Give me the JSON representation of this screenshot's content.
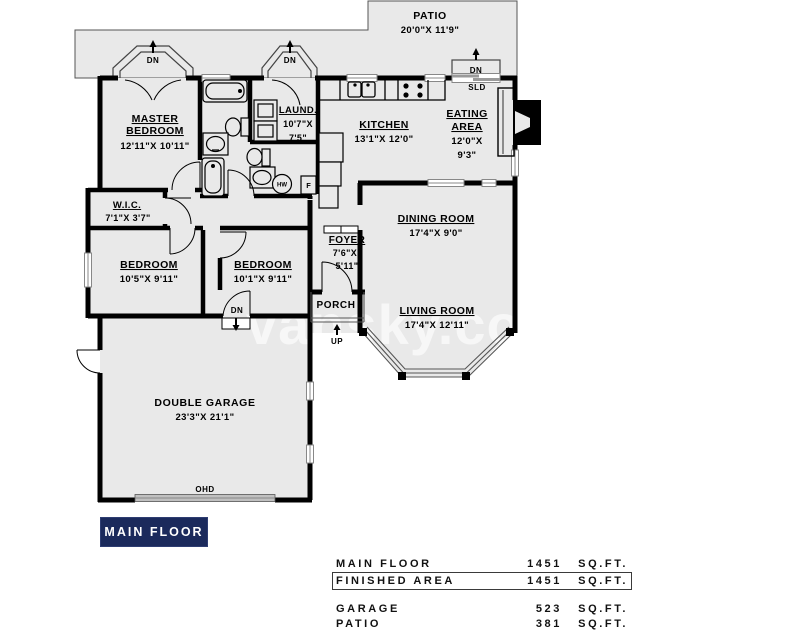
{
  "watermark": "vansky.com",
  "badge": {
    "label": "MAIN FLOOR"
  },
  "rooms": {
    "patio": {
      "name": "PATIO",
      "dims": "20'0\"X  11'9\""
    },
    "master": {
      "line1": "MASTER",
      "line2": "BEDROOM",
      "dims": "12'11\"X  10'11\""
    },
    "laundry": {
      "name": "LAUND.",
      "dims1": "10'7\"X",
      "dims2": "7'5\""
    },
    "kitchen": {
      "name": "KITCHEN",
      "dims": "13'1\"X  12'0\""
    },
    "eating": {
      "line1": "EATING",
      "line2": "AREA",
      "dims1": "12'0\"X",
      "dims2": "9'3\""
    },
    "dining": {
      "name": "DINING  ROOM",
      "dims": "17'4\"X  9'0\""
    },
    "wic": {
      "name": "W.I.C.",
      "dims": "7'1\"X  3'7\""
    },
    "bedroom_left": {
      "name": "BEDROOM",
      "dims": "10'5\"X  9'11\""
    },
    "bedroom_mid": {
      "name": "BEDROOM",
      "dims": "10'1\"X  9'11\""
    },
    "foyer": {
      "name": "FOYER",
      "dims1": "7'6\"X",
      "dims2": "5'11\""
    },
    "porch": {
      "name": "PORCH"
    },
    "living": {
      "name": "LIVING  ROOM",
      "dims": "17'4\"X  12'11\""
    },
    "garage": {
      "name": "DOUBLE  GARAGE",
      "dims": "23'3\"X  21'1\""
    }
  },
  "annotations": {
    "dn": "DN",
    "up": "UP",
    "sld": "SLD",
    "ohd": "OHD",
    "hw": "HW",
    "f": "F"
  },
  "area_table": {
    "rows": [
      {
        "label": "MAIN FLOOR",
        "value": "1451",
        "unit": "SQ.FT."
      },
      {
        "label": "FINISHED AREA",
        "value": "1451",
        "unit": "SQ.FT."
      },
      {
        "label": "GARAGE",
        "value": "523",
        "unit": "SQ.FT."
      },
      {
        "label": "PATIO",
        "value": "381",
        "unit": "SQ.FT."
      }
    ]
  },
  "colors": {
    "wall": "#000000",
    "floor": "#e9e9e9",
    "badge_bg": "#1b2a5c",
    "badge_text": "#ffffff"
  }
}
